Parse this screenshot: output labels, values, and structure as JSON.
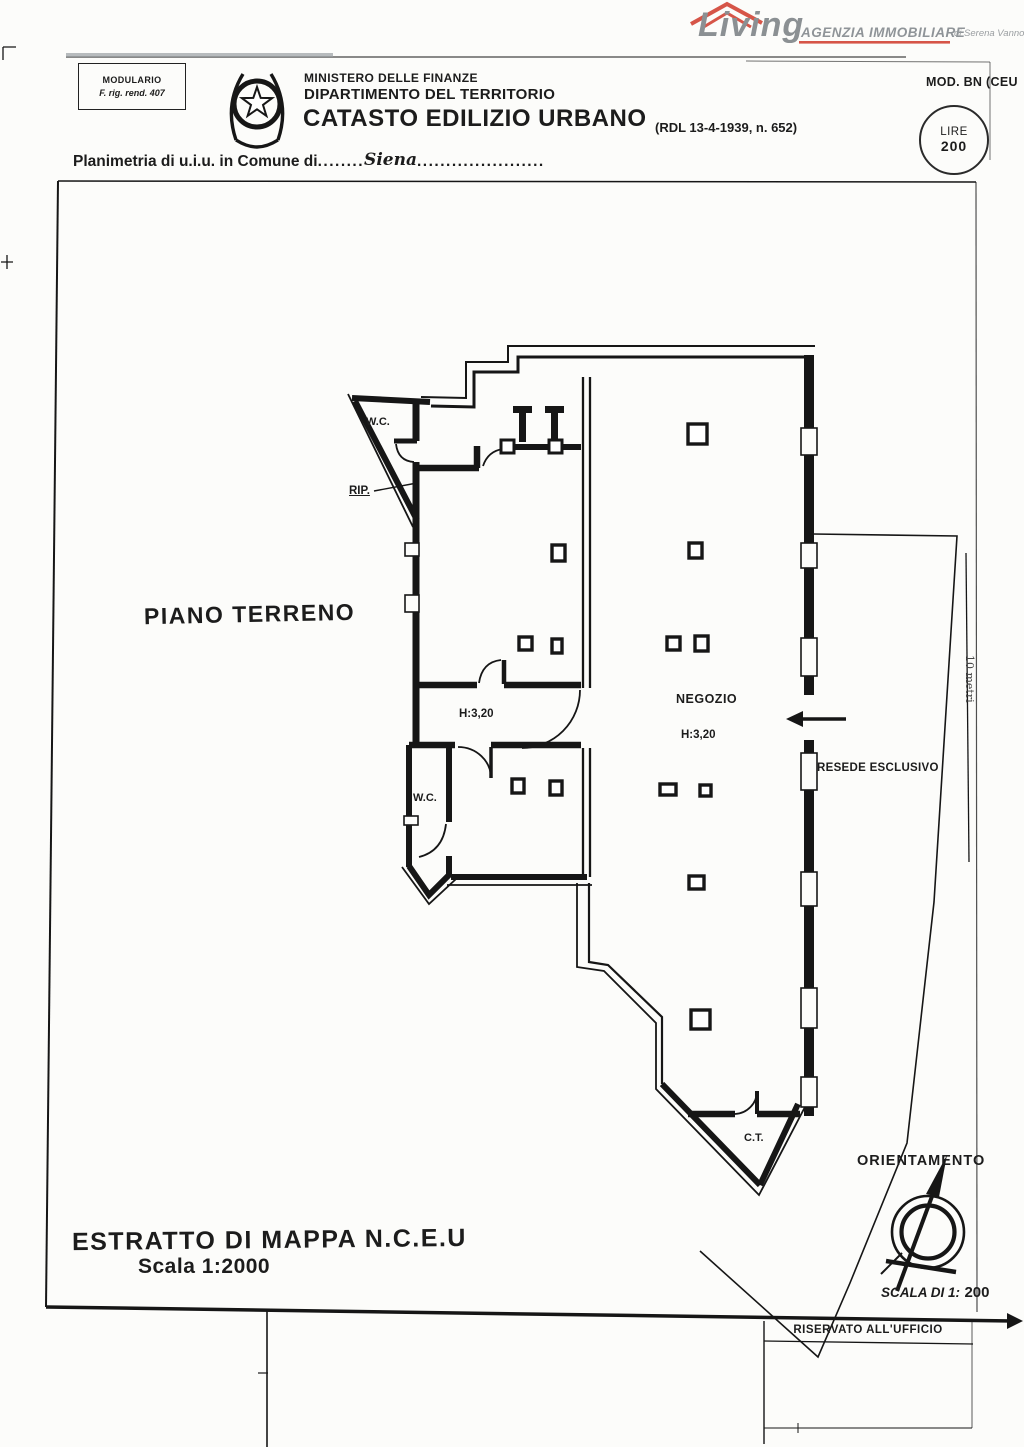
{
  "brand": {
    "name": "Living",
    "tagline": "AGENZIA IMMOBILIARE",
    "subtitle": "di Serena Vannoni",
    "accent_red": "#d65548",
    "gray": "#8b9093"
  },
  "form": {
    "modulario_title": "MODULARIO",
    "modulario_sub": "F. rig. rend. 407",
    "ministry": "MINISTERO DELLE FINANZE",
    "department": "DIPARTIMENTO DEL TERRITORIO",
    "catasto_title": "CATASTO EDILIZIO URBANO",
    "catasto_ref": "(RDL 13-4-1939, n. 652)",
    "mod_code": "MOD. BN (CEU",
    "stamp_top": "LIRE",
    "stamp_value": "200",
    "planimetria_label": "Planimetria di u.i.u. in Comune di",
    "dots_before": "........",
    "comune": "Siena",
    "dots_after": "......................",
    "riservato": "RISERVATO ALL'UFFICIO"
  },
  "plan": {
    "floor": "PIANO TERRENO",
    "wc_top": "W.C.",
    "rip": "RIP.",
    "hall_height": "H:3,20",
    "wc_bottom": "W.C.",
    "shop": "NEGOZIO",
    "shop_height": "H:3,20",
    "resede": "RESEDE ESCLUSIVO",
    "ct": "C.T.",
    "scale_bar": "10 metri"
  },
  "footer": {
    "estratto_title": "ESTRATTO DI MAPPA N.C.E.U",
    "estratto_scale": "Scala 1:2000",
    "orientamento": "ORIENTAMENTO",
    "scala_label": "SCALA DI 1:",
    "scala_value": "200"
  }
}
